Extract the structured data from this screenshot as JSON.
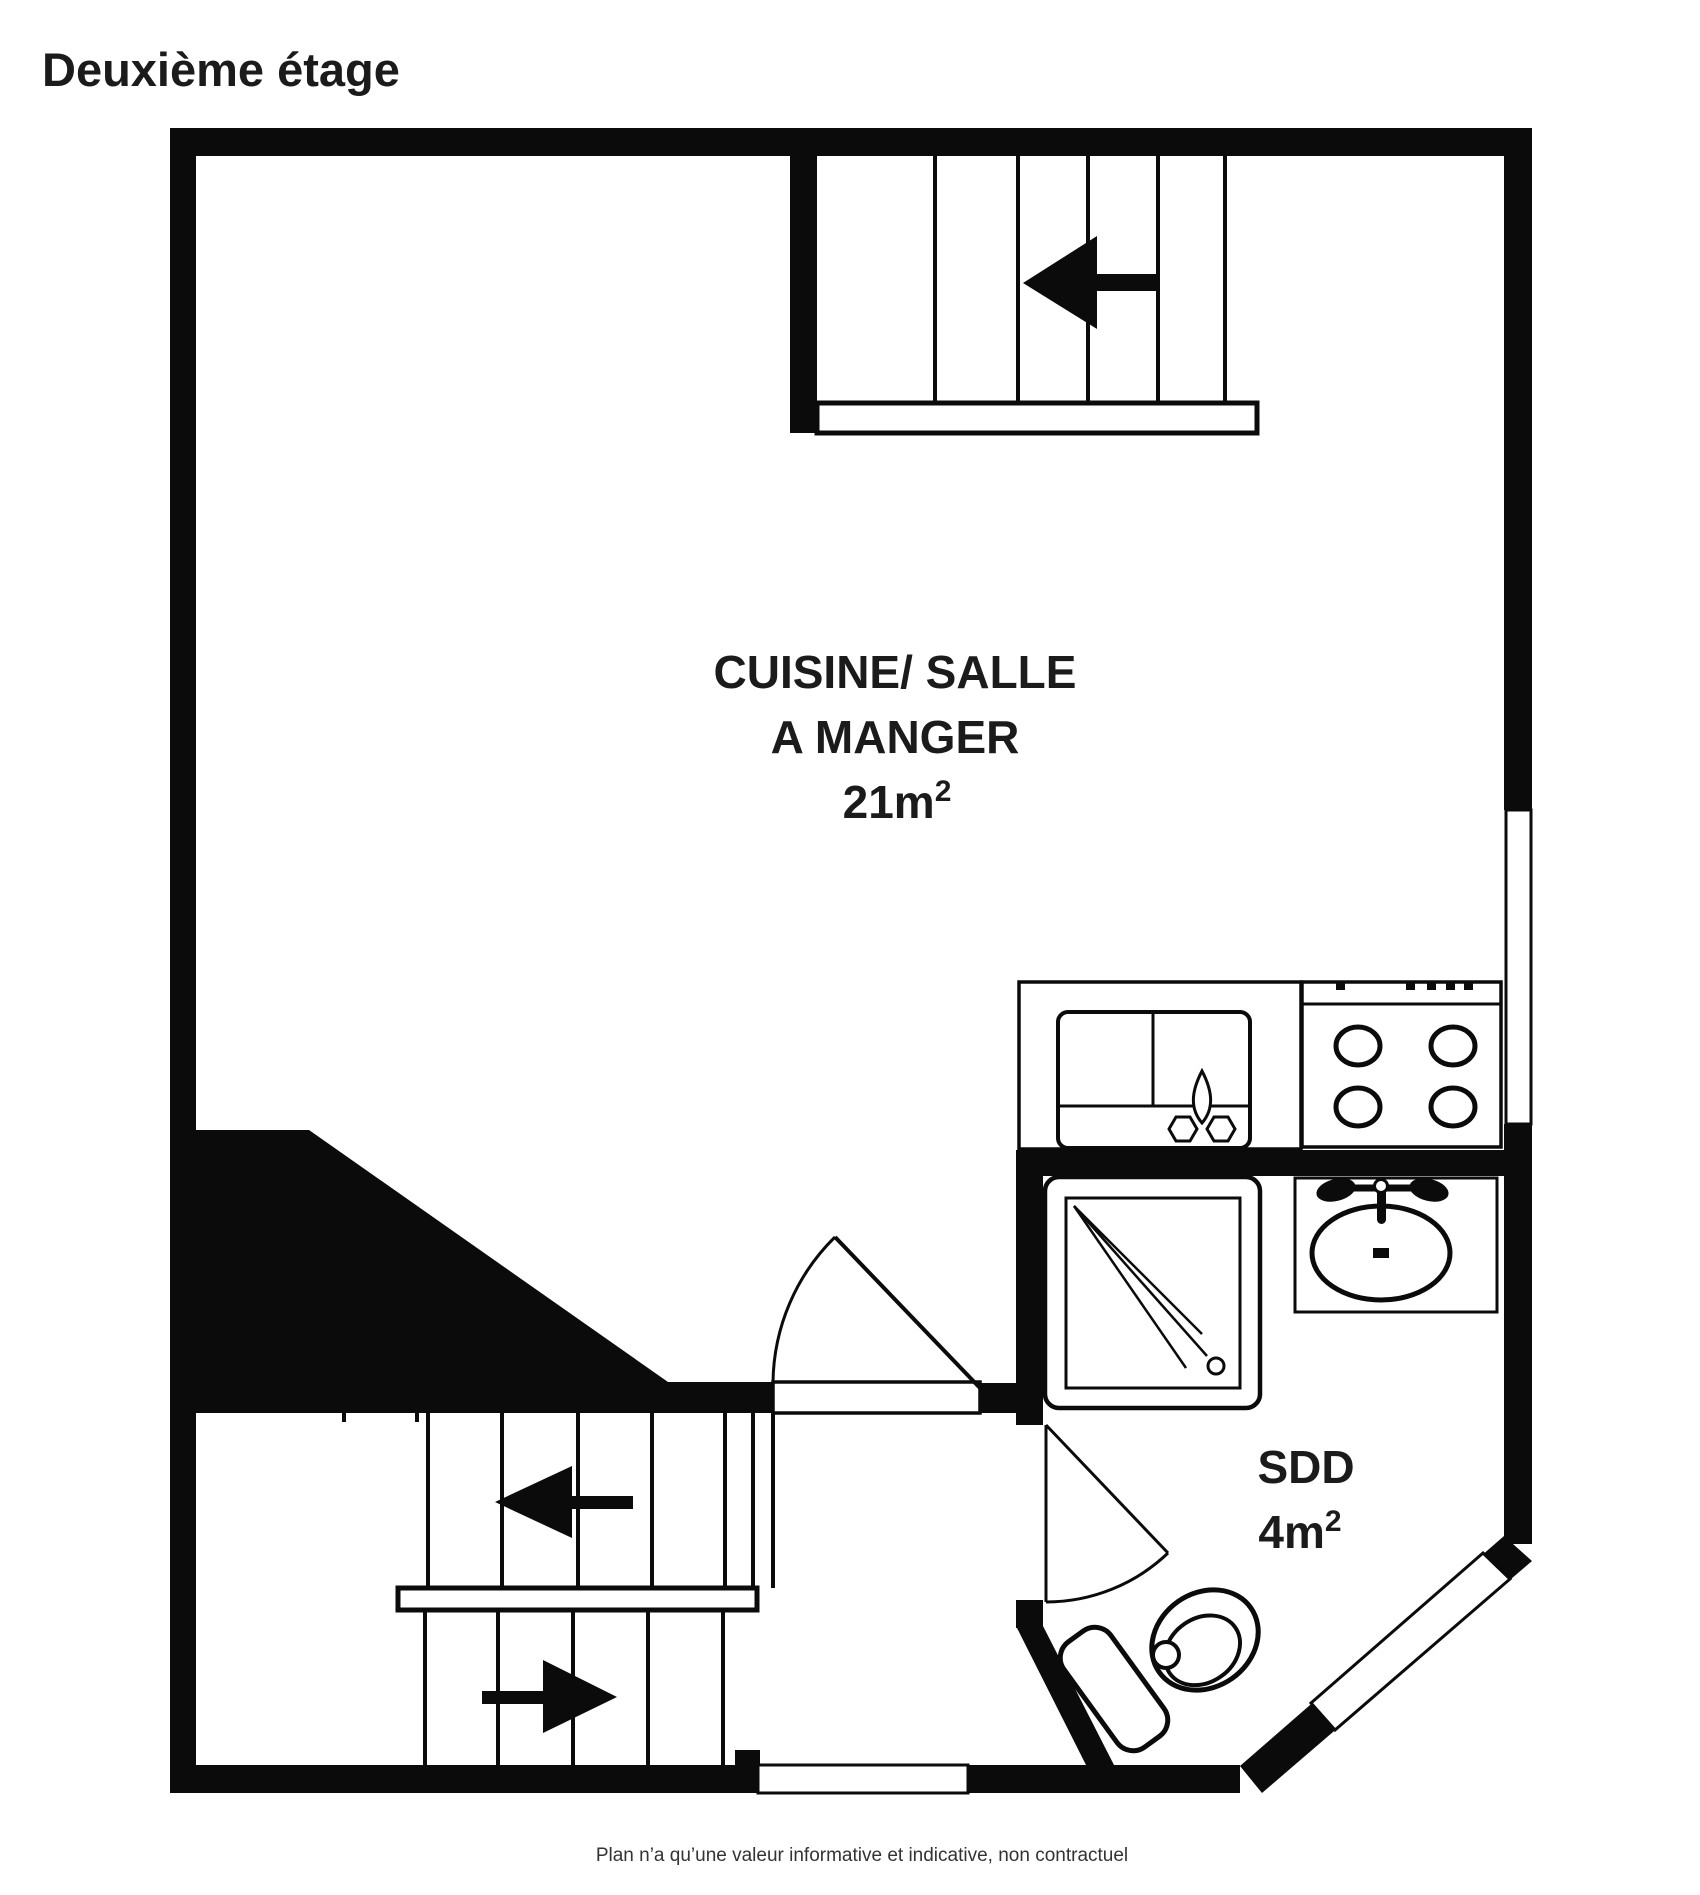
{
  "title": "Deuxième étage",
  "kitchen": {
    "name_line1": "CUISINE/ SALLE",
    "name_line2": "A MANGER",
    "area_base": "21m",
    "area_sup": "2"
  },
  "bathroom": {
    "name": "SDD",
    "area_base": "4m",
    "area_sup": "2"
  },
  "footer": "Plan n’a qu’une valeur informative et indicative, non contractuel",
  "colors": {
    "wall": "#0b0b0b",
    "background": "#ffffff",
    "text": "#1b1b1b",
    "footer_text": "#333333"
  }
}
